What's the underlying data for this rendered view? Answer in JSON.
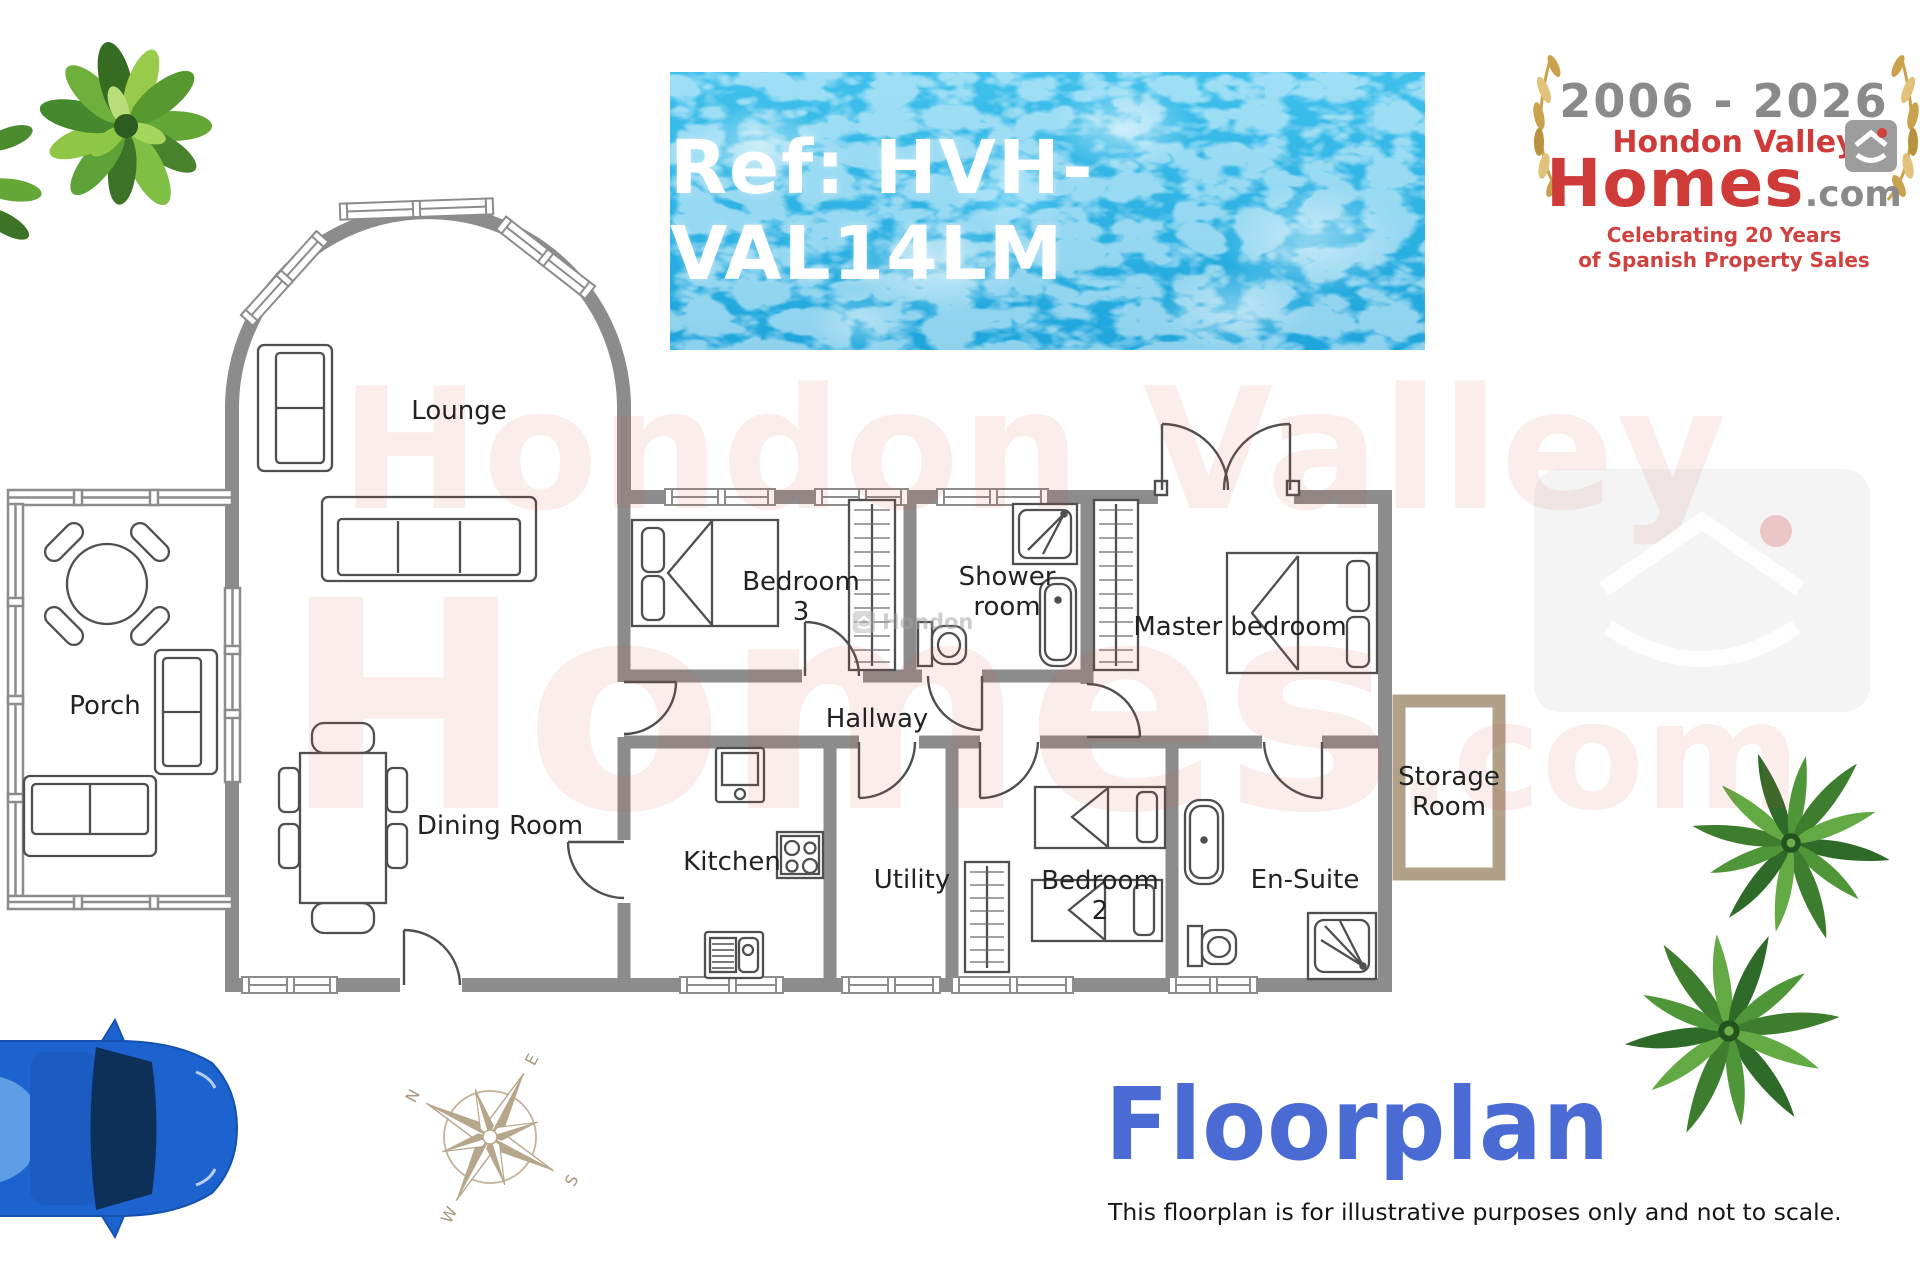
{
  "banner": {
    "reference": "Ref: HVH-VAL14LM"
  },
  "logo": {
    "years": "2006 - 2026",
    "name_top": "Hondon Valley",
    "name_main": "Homes",
    "name_tld": ".com",
    "tagline_line1": "Celebrating 20 Years",
    "tagline_line2": "of Spanish Property Sales"
  },
  "watermark": {
    "line1": "Hondon Valley",
    "line2": "Homes",
    "line2_suffix": ".com",
    "small_text": "Hondon"
  },
  "rooms": {
    "lounge": "Lounge",
    "porch": "Porch",
    "dining_room": "Dining Room",
    "bedroom3_line1": "Bedroom",
    "bedroom3_line2": "3",
    "shower_line1": "Shower",
    "shower_line2": "room",
    "master_bedroom": "Master bedroom",
    "hallway": "Hallway",
    "kitchen": "Kitchen",
    "utility": "Utility",
    "bedroom2_line1": "Bedroom",
    "bedroom2_line2": "2",
    "ensuite": "En-Suite",
    "storage_line1": "Storage",
    "storage_line2": "Room"
  },
  "compass": {
    "north": "N",
    "east": "E",
    "south": "S",
    "west": "W"
  },
  "footer": {
    "title": "Floorplan",
    "disclaimer": "This floorplan is for illustrative purposes only and not to scale."
  },
  "colors": {
    "wall_gray": "#8a8a8a",
    "storage_tan": "#b3a089",
    "banner_blue": "#2cb0e2",
    "brand_red": "#cf3b38",
    "title_blue": "#4a6bd3",
    "laurel_gold": "#c9a24b"
  }
}
